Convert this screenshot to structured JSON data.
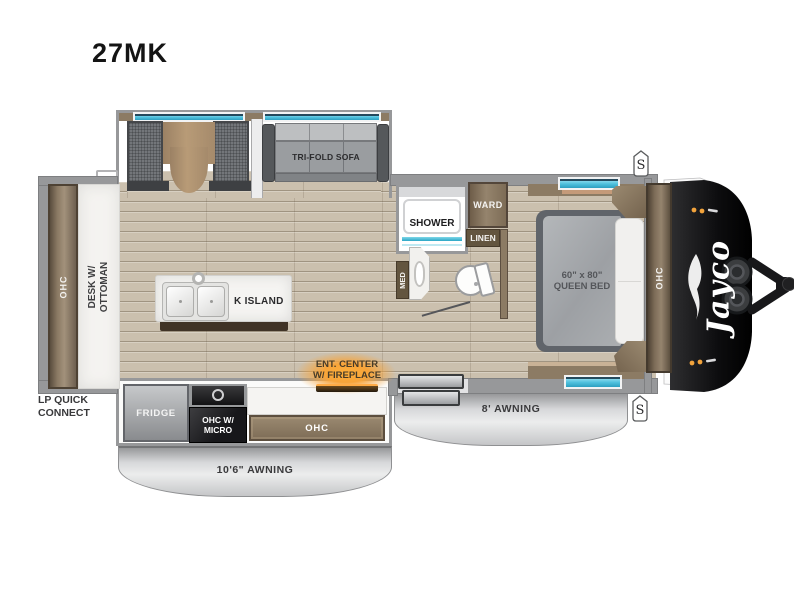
{
  "title": "27MK",
  "speaker_badge": "S",
  "brand": "Jayco",
  "living": {
    "sofa": "TRI-FOLD SOFA"
  },
  "bath": {
    "shower": "SHOWER",
    "ward": "WARD",
    "linen": "LINEN",
    "med": "MED"
  },
  "bedroom": {
    "bed_size": "60\" x 80\"",
    "bed_name": "QUEEN BED",
    "ohc": "OHC"
  },
  "rear": {
    "ohc": "OHC",
    "desk_line1": "DESK W/",
    "desk_line2": "OTTOMAN",
    "lp_line1": "LP QUICK",
    "lp_line2": "CONNECT"
  },
  "kitchen": {
    "island": "K ISLAND",
    "fridge": "FRIDGE",
    "micro_line1": "OHC W/",
    "micro_line2": "MICRO",
    "ohc": "OHC",
    "ent_line1": "ENT. CENTER",
    "ent_line2": "W/ FIREPLACE"
  },
  "awnings": {
    "main": "10'6\" AWNING",
    "door": "8' AWNING"
  },
  "colors": {
    "floor": "#cbc0ae",
    "wall": "#97989a",
    "cabinet_wood": "#8c7b64",
    "awning": "#d7d8da",
    "window_glass": "#4fc0dd",
    "fireplace_glow": "#f7a43a",
    "front_cap": "#0d0d0f",
    "label_text": "#39393b"
  }
}
